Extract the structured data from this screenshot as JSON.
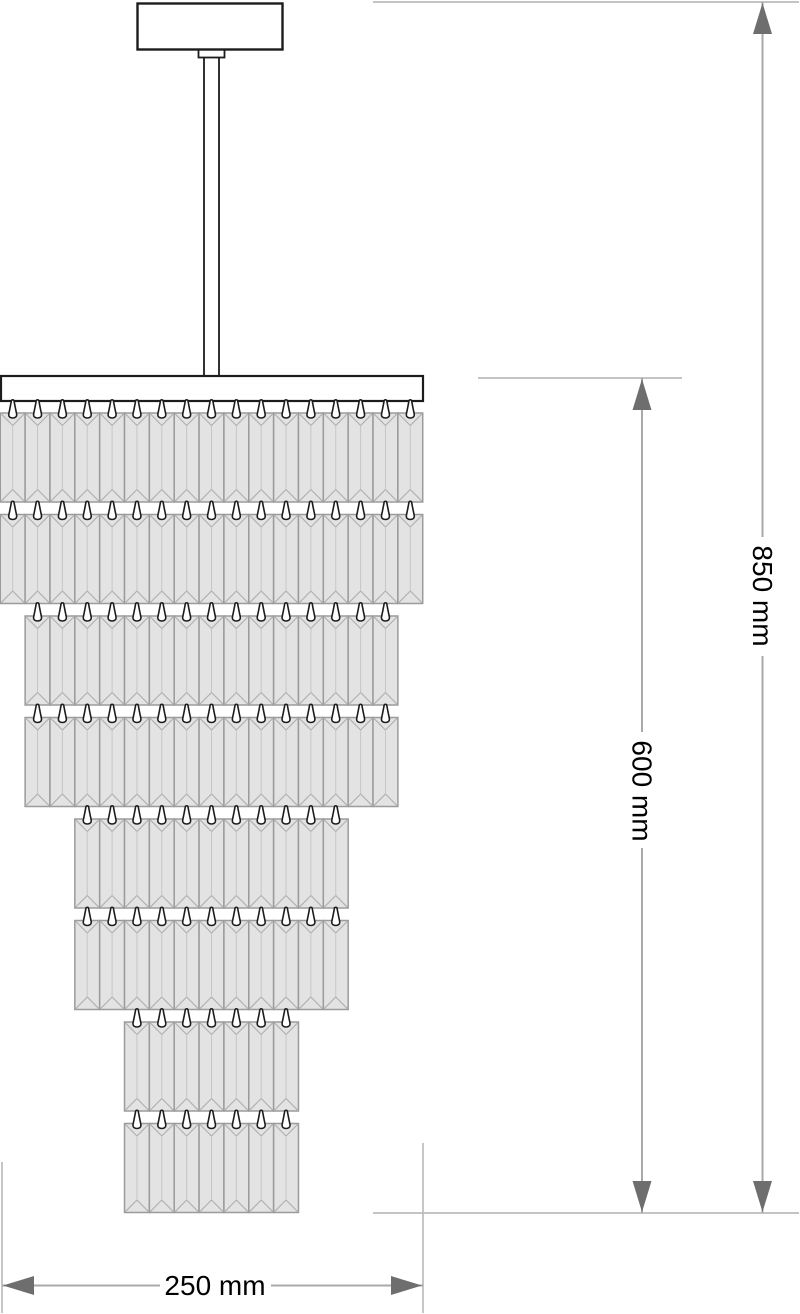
{
  "drawing": {
    "labels": {
      "overall_height": "850 mm",
      "body_height": "600 mm",
      "width": "250 mm"
    },
    "colors": {
      "background": "#ffffff",
      "fixture_outline": "#1c1c1c",
      "fixture_fill": "#ffffff",
      "crystal_fill": "#e3e3e3",
      "crystal_border": "#9b9b9b",
      "crystal_facet": "#b1b1b1",
      "crystal_center_line": "#c6c6c6",
      "hook_outline": "#1c1c1c",
      "hook_fill": "#ffffff",
      "dimension_line": "#a9a9a9",
      "extension_line": "#bcbcbc",
      "arrow": "#6e6e6e",
      "label_text": "#000000"
    },
    "structure": {
      "center_x": 211.5,
      "canopy": {
        "x": 137.5,
        "y": 3.5,
        "width": 145,
        "height": 46
      },
      "connector": {
        "width": 26,
        "height": 8
      },
      "rod": {
        "width": 15,
        "top": 51,
        "bottom": 377
      },
      "top_plate": {
        "x": 1,
        "y": 376,
        "width": 422,
        "height": 25
      },
      "crystal": {
        "width": 24.85,
        "height": 89,
        "row_pitch": 101.5,
        "first_row_top": 413,
        "facet_inset": 12.5,
        "hook_height": 18,
        "hook_width": 8
      },
      "tiers": [
        {
          "name": "tier-1",
          "rows": 2,
          "crystals_per_row": 17
        },
        {
          "name": "tier-2",
          "rows": 2,
          "crystals_per_row": 15
        },
        {
          "name": "tier-3",
          "rows": 2,
          "crystals_per_row": 11
        },
        {
          "name": "tier-4",
          "rows": 2,
          "crystals_per_row": 7
        }
      ]
    },
    "dimensions": {
      "overall_height": {
        "label": "850 mm",
        "axis": "vertical",
        "x": 762.5,
        "from": 2,
        "to": 1213,
        "text_center": 596,
        "text_gap": [
          537,
          656
        ]
      },
      "body_height": {
        "label": "600 mm",
        "axis": "vertical",
        "x": 642,
        "from": 378,
        "to": 1213,
        "text_center": 791,
        "text_gap": [
          732,
          848
        ]
      },
      "width": {
        "label": "250 mm",
        "axis": "horizontal",
        "y": 1285.5,
        "from": 2,
        "to": 423,
        "text_center": 215,
        "text_gap": [
          160,
          271
        ]
      }
    },
    "extension_lines": [
      {
        "x1": 373,
        "y1": 2,
        "x2": 799,
        "y2": 2
      },
      {
        "x1": 478,
        "y1": 378,
        "x2": 682,
        "y2": 378
      },
      {
        "x1": 373,
        "y1": 1213,
        "x2": 799,
        "y2": 1213
      },
      {
        "x1": 2,
        "y1": 1162,
        "x2": 2,
        "y2": 1313
      },
      {
        "x1": 423,
        "y1": 1143,
        "x2": 423,
        "y2": 1313
      }
    ]
  }
}
